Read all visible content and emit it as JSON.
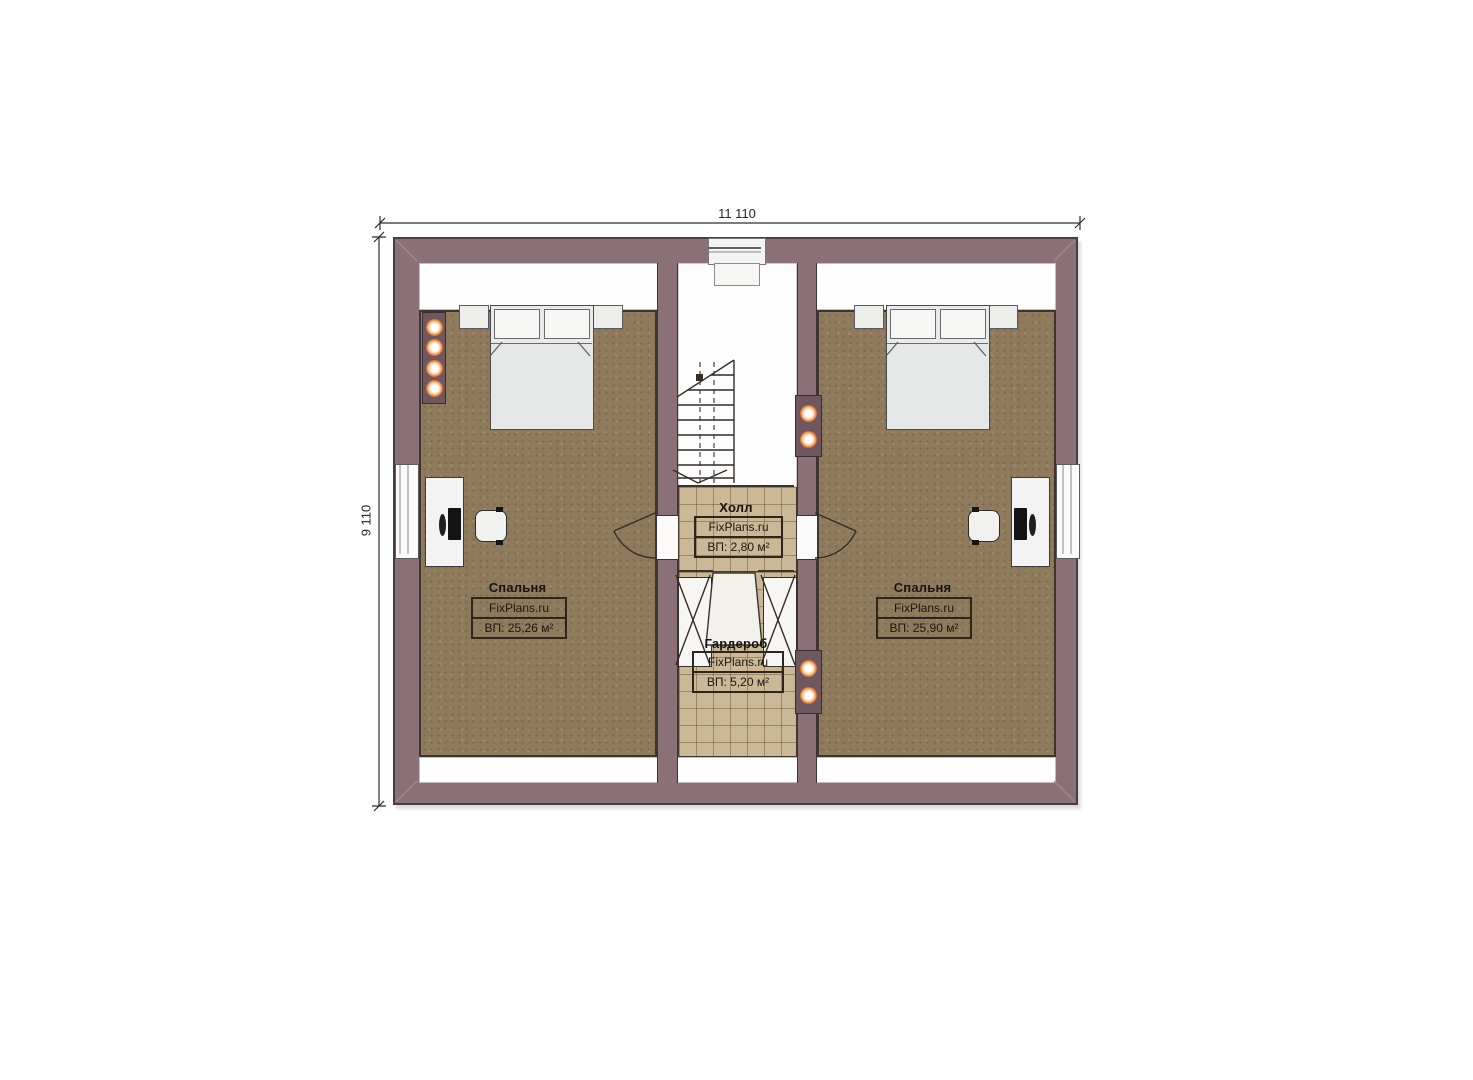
{
  "dimensions": {
    "top": "11 110",
    "left": "9 110"
  },
  "rooms": {
    "bedroom_left": {
      "name": "Спальня",
      "watermark": "FixPlans.ru",
      "area": "ВП: 25,26 м²"
    },
    "bedroom_right": {
      "name": "Спальня",
      "watermark": "FixPlans.ru",
      "area": "ВП: 25,90 м²"
    },
    "hall": {
      "name": "Холл",
      "watermark": "FixPlans.ru",
      "area": "ВП: 2,80 м²"
    },
    "wardrobe": {
      "name": "Гардероб",
      "watermark": "FixPlans.ru",
      "area": "ВП: 5,20 м²"
    }
  },
  "colors": {
    "paper": "#ffffff",
    "wall": "#8b7077",
    "wall_dark": "#6e575e",
    "floor_bedroom": "#8f7b5c",
    "floor_tile": "#cab896",
    "tile_line": "#8a7148",
    "line_dark": "#342d28",
    "accent_light": "#e2782e"
  },
  "icons": {
    "lamp": "wall-spotlight",
    "stairs": "staircase-up",
    "door": "door-swing"
  }
}
